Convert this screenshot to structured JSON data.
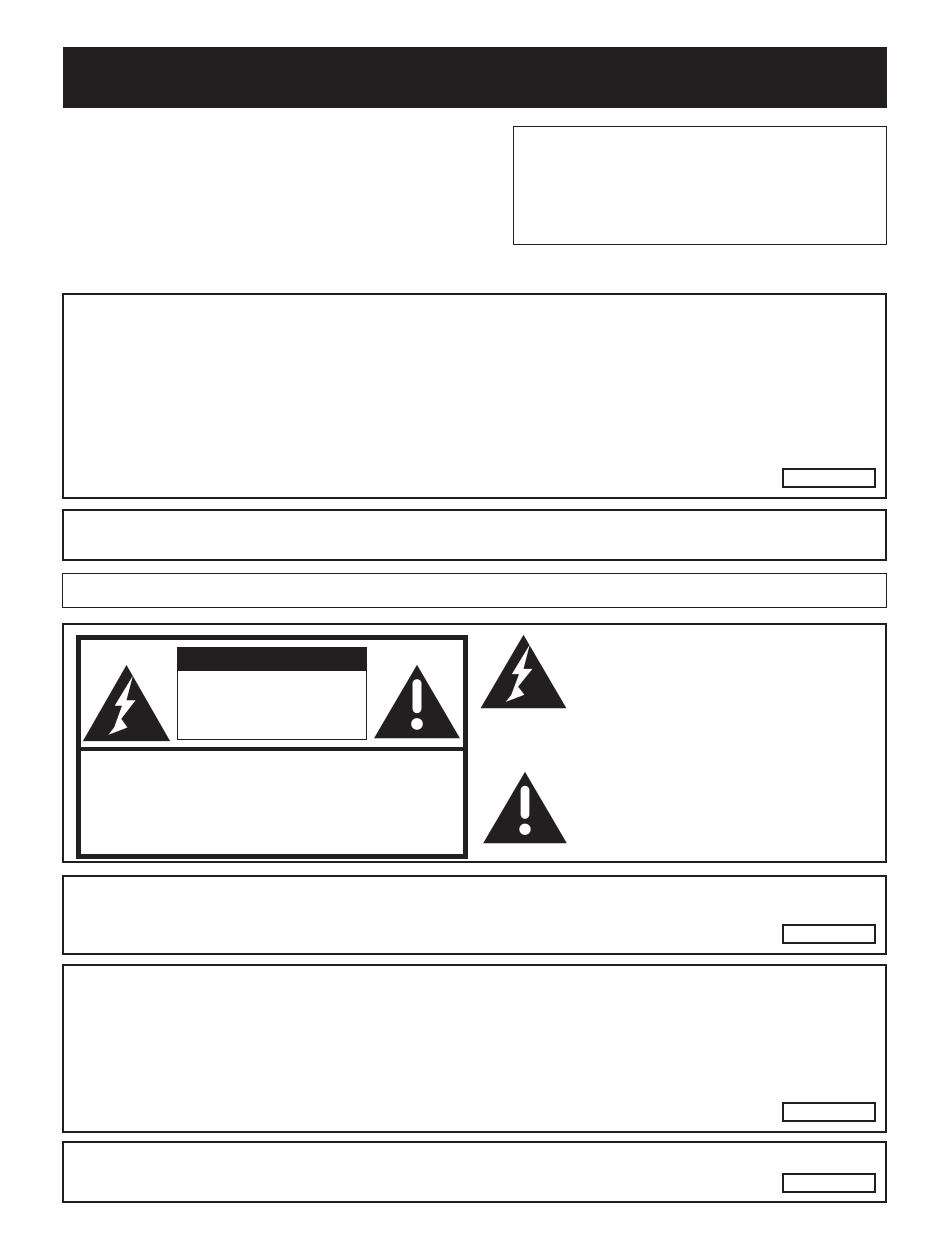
{
  "colors": {
    "ink": "#231f20",
    "paper": "#ffffff"
  },
  "header": {
    "title": ""
  },
  "note_box": {
    "text": ""
  },
  "warning_box": {
    "text": "",
    "chip_label": ""
  },
  "notice_box_1": {
    "text": ""
  },
  "notice_box_2": {
    "text": ""
  },
  "caution_panel": {
    "label": {
      "title_bar_text": "",
      "text_box_text": "",
      "lower_text": ""
    },
    "side_symbols": [
      {
        "icon": "high-voltage-triangle",
        "description": ""
      },
      {
        "icon": "alert-triangle",
        "description": ""
      }
    ]
  },
  "info_box_1": {
    "text": "",
    "chip_label": ""
  },
  "info_box_2": {
    "text": "",
    "chip_label": ""
  },
  "info_box_3": {
    "text": "",
    "chip_label": ""
  },
  "icons": {
    "high_voltage": "lightning-bolt-in-black-triangle",
    "alert": "exclamation-mark-in-black-triangle"
  }
}
